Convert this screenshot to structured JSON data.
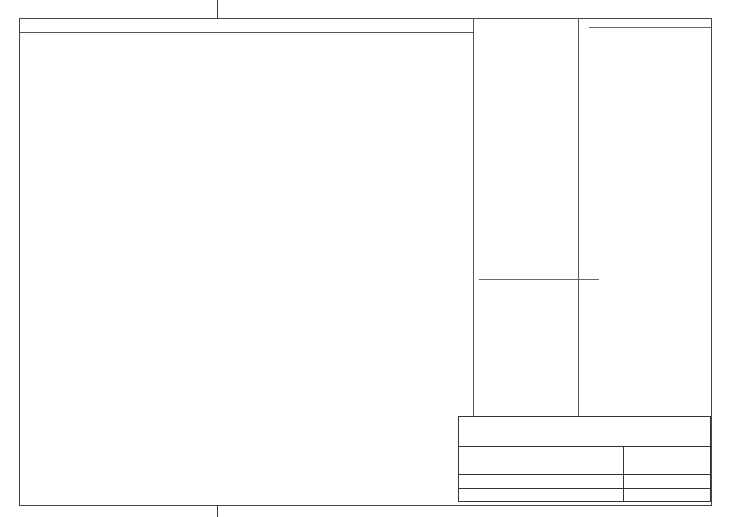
{
  "plan": {
    "title": "Ciclo 1",
    "marker_a": "\"A\"",
    "marker_1": "\"1\"",
    "scale_note": "Scale 1:50   Altezza sezione 10cm",
    "dims": {
      "top": [
        "25",
        "210",
        "25",
        "760",
        "25"
      ],
      "top_total": "1045 cm",
      "bottom": [
        "25",
        "300",
        "25",
        "665",
        "30"
      ],
      "bottom_total": "1045 cm",
      "left": [
        "30",
        "134",
        "20",
        "255",
        "20",
        "185",
        "20"
      ],
      "left_total": "664 cm",
      "right": [
        "30",
        "614",
        "20"
      ],
      "right_total": "664 cm",
      "right_inner": [
        "270"
      ],
      "right_inner_total": "270 cm"
    }
  },
  "sezione": {
    "title": "Sezione \"1\"",
    "scale": "Scale 1:50",
    "dims": [
      "30",
      "240"
    ],
    "dims_total": "270 cm",
    "thickness": "25 cm"
  },
  "vista": {
    "title": "Vista laterale \"A\"",
    "scale": "Scale 1:50",
    "top_labels": [
      "240x30",
      "240x30",
      "240x30"
    ],
    "panels": [
      "40x240",
      "60x240",
      "Lamiera 40x240",
      "60x240",
      "60x240",
      "60x240",
      "60x240",
      "60x240",
      "60x240",
      "60x240",
      "60x240",
      "60x240",
      "40x240",
      "50x240",
      "40x240"
    ],
    "dims": {
      "left": [
        "30",
        "240"
      ],
      "left_total": "270 cm",
      "bottom_center": "810",
      "bottom_total": "810 cm"
    }
  },
  "elenco": {
    "title": "Elenco materiale  Ciclo 1",
    "col_ciclo": "Ciclo 1",
    "col_denominazione": "Denominazione",
    "groups": [
      {
        "name": "Pannelli",
        "items": [
          {
            "qty": "86",
            "name": "Pannello 60x240"
          },
          {
            "qty": "3",
            "name": "Pannello 50x240"
          },
          {
            "qty": "12",
            "name": "Pann.di compenso 40x240"
          },
          {
            "qty": "22",
            "name": "Pannello 30x240"
          },
          {
            "qty": "1",
            "name": "Pannello 60x240 pilastri"
          },
          {
            "qty": "14",
            "name": "Pann.di compenso 40x240"
          },
          {
            "qty": "6",
            "name": "Pann.Ang.Int. 25+20x240"
          },
          {
            "qty": "6",
            "name": "Pann.Ang.Int. 10+10x240"
          },
          {
            "qty": "5",
            "name": "Pann.Ang.Est. 5+10x240"
          },
          {
            "qty": "4",
            "name": "Pann.Ang.Est. 5+5x240"
          },
          {
            "qty": "24",
            "name": "Pannello 60x120"
          },
          {
            "qty": "1",
            "name": "Pannello 50x120"
          },
          {
            "qty": "12",
            "name": "Pannello 40x120"
          },
          {
            "qty": "12",
            "name": "Pannello 30x120"
          },
          {
            "qty": "1",
            "name": "Pannello 60x120 pilastri"
          },
          {
            "qty": "2",
            "name": "Asta di compenso 5x120"
          },
          {
            "qty": "12",
            "name": "Pann.di compenso 40x120"
          },
          {
            "qty": "6",
            "name": "Pann.Ang.Int. 25+20x120"
          },
          {
            "qty": "5",
            "name": "Pann.Ang.Est. 5+10x120"
          }
        ]
      },
      {
        "name": "Accessori",
        "items": [
          {
            "qty": "413",
            "name": "Morsetto P.60"
          },
          {
            "qty": "2",
            "name": "Blocco a vite P.60"
          },
          {
            "qty": "40",
            "name": "Barra filettata da 25serie 15"
          },
          {
            "qty": "304",
            "name": "Morsa diametro 13serie 15"
          },
          {
            "qty": "4",
            "name": "Morsa orientabile serie 15"
          },
          {
            "qty": "96",
            "name": "Dado serie 15"
          },
          {
            "qty": "154",
            "name": "Barra filettata da 75serie 15"
          },
          {
            "qty": "308",
            "name": "Tappo diam. 22(confezione da 2000pz)"
          },
          {
            "qty": "308",
            "name": "Cono distanziatore diam.20(confez. da 1000pz)"
          },
          {
            "qty": "22",
            "name": "Mensola di servizio nuovo tipo completa"
          },
          {
            "qty": "21",
            "name": "Puntello reg.200/350 con staffa e coll."
          },
          {
            "qty": "96",
            "name": "Rondella per barra filettata"
          },
          {
            "qty": "21",
            "name": "Braccio re. 110/150 per piombatura compl."
          }
        ]
      },
      {
        "name": "Alto",
        "items": [
          {
            "qty": "40",
            "name": "Traversa 70 cm(da parte del cliente)"
          },
          {
            "qty": "64",
            "name": "Tubo in PVC 30 cm (da parte del cliente)"
          },
          {
            "qty": "69",
            "name": "Tubo in PVC 25 cm (da parte del cliente)"
          },
          {
            "qty": "41",
            "name": "Tubo in PVC 20 cm (da parte del cliente)"
          }
        ]
      }
    ]
  },
  "info": {
    "title": "Informazioni cicli  ciclo 1 fino 1",
    "headers": [
      "Informazioni",
      "Fornitura",
      "Ciclo 1"
    ],
    "rows": [
      [
        "Sup. di armatura",
        "180,79 m²",
        "180,79 m²"
      ],
      [
        "Sup. totale pannelli",
        "217,92 m²",
        "217,92 m²"
      ],
      [
        "Impegno magazzino",
        "100 %",
        "100 %"
      ],
      [
        "Volume cemento armato",
        "24,62 m³",
        "24,62 m³"
      ],
      [
        "Metri correnti",
        "34,580 m",
        "34,580 m"
      ],
      [
        "Altezza pareti",
        "270,0 cm",
        "270,0 cm"
      ],
      [
        "Peso cassero",
        "12006,7 Kg",
        "12006,7 Kg"
      ],
      [
        "Tempo di casseratura",
        "0:00 ora",
        "0:00 ora"
      ],
      [
        "Tempo di disarmo",
        "0:00 ora",
        "0:00 ora"
      ],
      [
        "prezzo di armatura",
        "0,00 €",
        "0,00 €"
      ]
    ]
  },
  "notes": [
    "N.B. IL DISEGNO DEVE ESSERE CONTROLLATO SOTTO LA RESPONSABILITA' DEL COSTRUTTORE!",
    "N.B. OSSERVARE LE ISTRUZIONI D'USO!",
    "N.B. OSSERVARE LE ISTRUZIONI D'USO!"
  ],
  "titleblock": {
    "company": "H.J. Schewe",
    "address1": "Pfaffingerstraße 27",
    "address2": "83533 Edling",
    "committente_label": "Committente",
    "committente": "EuroSchal Homepage",
    "autore_label": "Autore",
    "autore": "H.J. Schewe",
    "progetto_label": "Progetto",
    "progetto": "Mustergrundriß",
    "file_label": "File",
    "file": "DEMO.WSL",
    "casseratura_label": "Casseratura",
    "casseratura": "Pilosio P 60 (Hauptlager)",
    "data_label": "Data",
    "data": "25.01.2022"
  },
  "colors": {
    "wall_concrete": "#f5caca",
    "panel_gray": "#c4c4c4",
    "prop_green": "#17b317",
    "accent_yellow": "#ffee00",
    "accent_cyan": "#26d7f2",
    "accent_red": "#cc1111"
  }
}
